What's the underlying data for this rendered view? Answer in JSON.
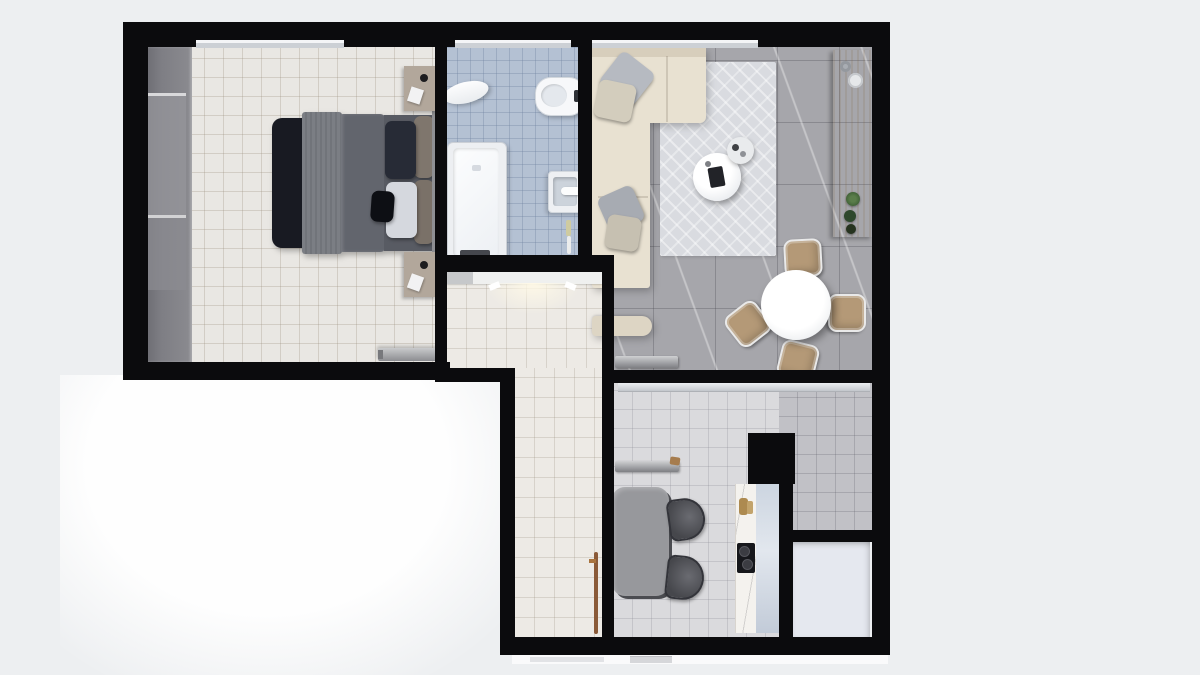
{
  "app": {
    "type": "apartment-floor-plan-render",
    "view": "top-down 3D render, no visible text labels"
  },
  "palette": {
    "canvas": "#edeff1",
    "wall": "#0b0b0d",
    "bedroomFloor": "#e9e7e3",
    "hallFloor": "#edeae5",
    "bathFloor": "#b4c1d3",
    "livingFloor": "#a6a6ab",
    "kitchenFloor": "#dadadd",
    "kitchenFloorDark": "#c1c1c6",
    "whiteRoomFloor": "#e5e8ef",
    "window": "#ccd0d5",
    "wardrobe": "#7e7e84",
    "sofa": "#e8e1d1",
    "rug": "#d9dbe0",
    "wood": "#d5b994",
    "bedFoot": "#181a22",
    "bedBlanket": "#7b7e84",
    "bedDuvet": "#62656d",
    "nightstand": "#b2a79b",
    "fixtureWhite": "#f7f8fa",
    "tableGray": "#97989c",
    "chairTan": "#b49977",
    "counterMarble": "#f4f2ee",
    "glassPanel": "#ccd5e0",
    "radiator": "#aaabae",
    "broom": "#8a5a38"
  },
  "rooms": [
    {
      "name": "bedroom",
      "position": "top-left",
      "floor": "cream ceramic tile",
      "furniture": [
        "wardrobe along left wall",
        "double bed with dark foot throw, striped runner, slate duvet",
        "navy pillow",
        "white pillow",
        "small black cushion",
        "two taupe bolster pillows",
        "nightstand top with tray and notepad",
        "nightstand bottom with tray and notepad",
        "metal bench / sliding door bar",
        "window on top wall"
      ]
    },
    {
      "name": "bathroom",
      "position": "top-center",
      "floor": "blue ceramic tile",
      "furniture": [
        "bathtub with dark mat",
        "toilet with cistern",
        "oval lid / bidet cover",
        "wall-hung washbasin with faucet",
        "toilet brush",
        "window on top wall"
      ]
    },
    {
      "name": "living-dining-room",
      "position": "top-right",
      "floor": "gray marble tile",
      "furniture": [
        "beige L-shaped sectional sofa with gray and cream cushions",
        "light area rug",
        "round white coffee table with dark tray",
        "small round side table",
        "wooden console sideboard with bowls and three green plants",
        "round white dining table",
        "four tan dining chairs",
        "wall radiator",
        "window on top wall"
      ]
    },
    {
      "name": "hallway",
      "position": "center, L-shaped",
      "floor": "cream ceramic tile",
      "furniture": [
        "entry door strip with light glow",
        "broom leaning in corner"
      ]
    },
    {
      "name": "kitchen-studio",
      "position": "bottom-center",
      "floor": "light gray ceramic tile",
      "furniture": [
        "glass partition track below living room",
        "gray rounded desk table",
        "two dark half-round chairs",
        "wall shelf / radiator bar",
        "marble kitchen counter with bottles and black cooktop",
        "glass splash panel",
        "structural column"
      ]
    },
    {
      "name": "utility-room",
      "position": "bottom-right",
      "floor": "plain off-white",
      "furniture": []
    }
  ]
}
